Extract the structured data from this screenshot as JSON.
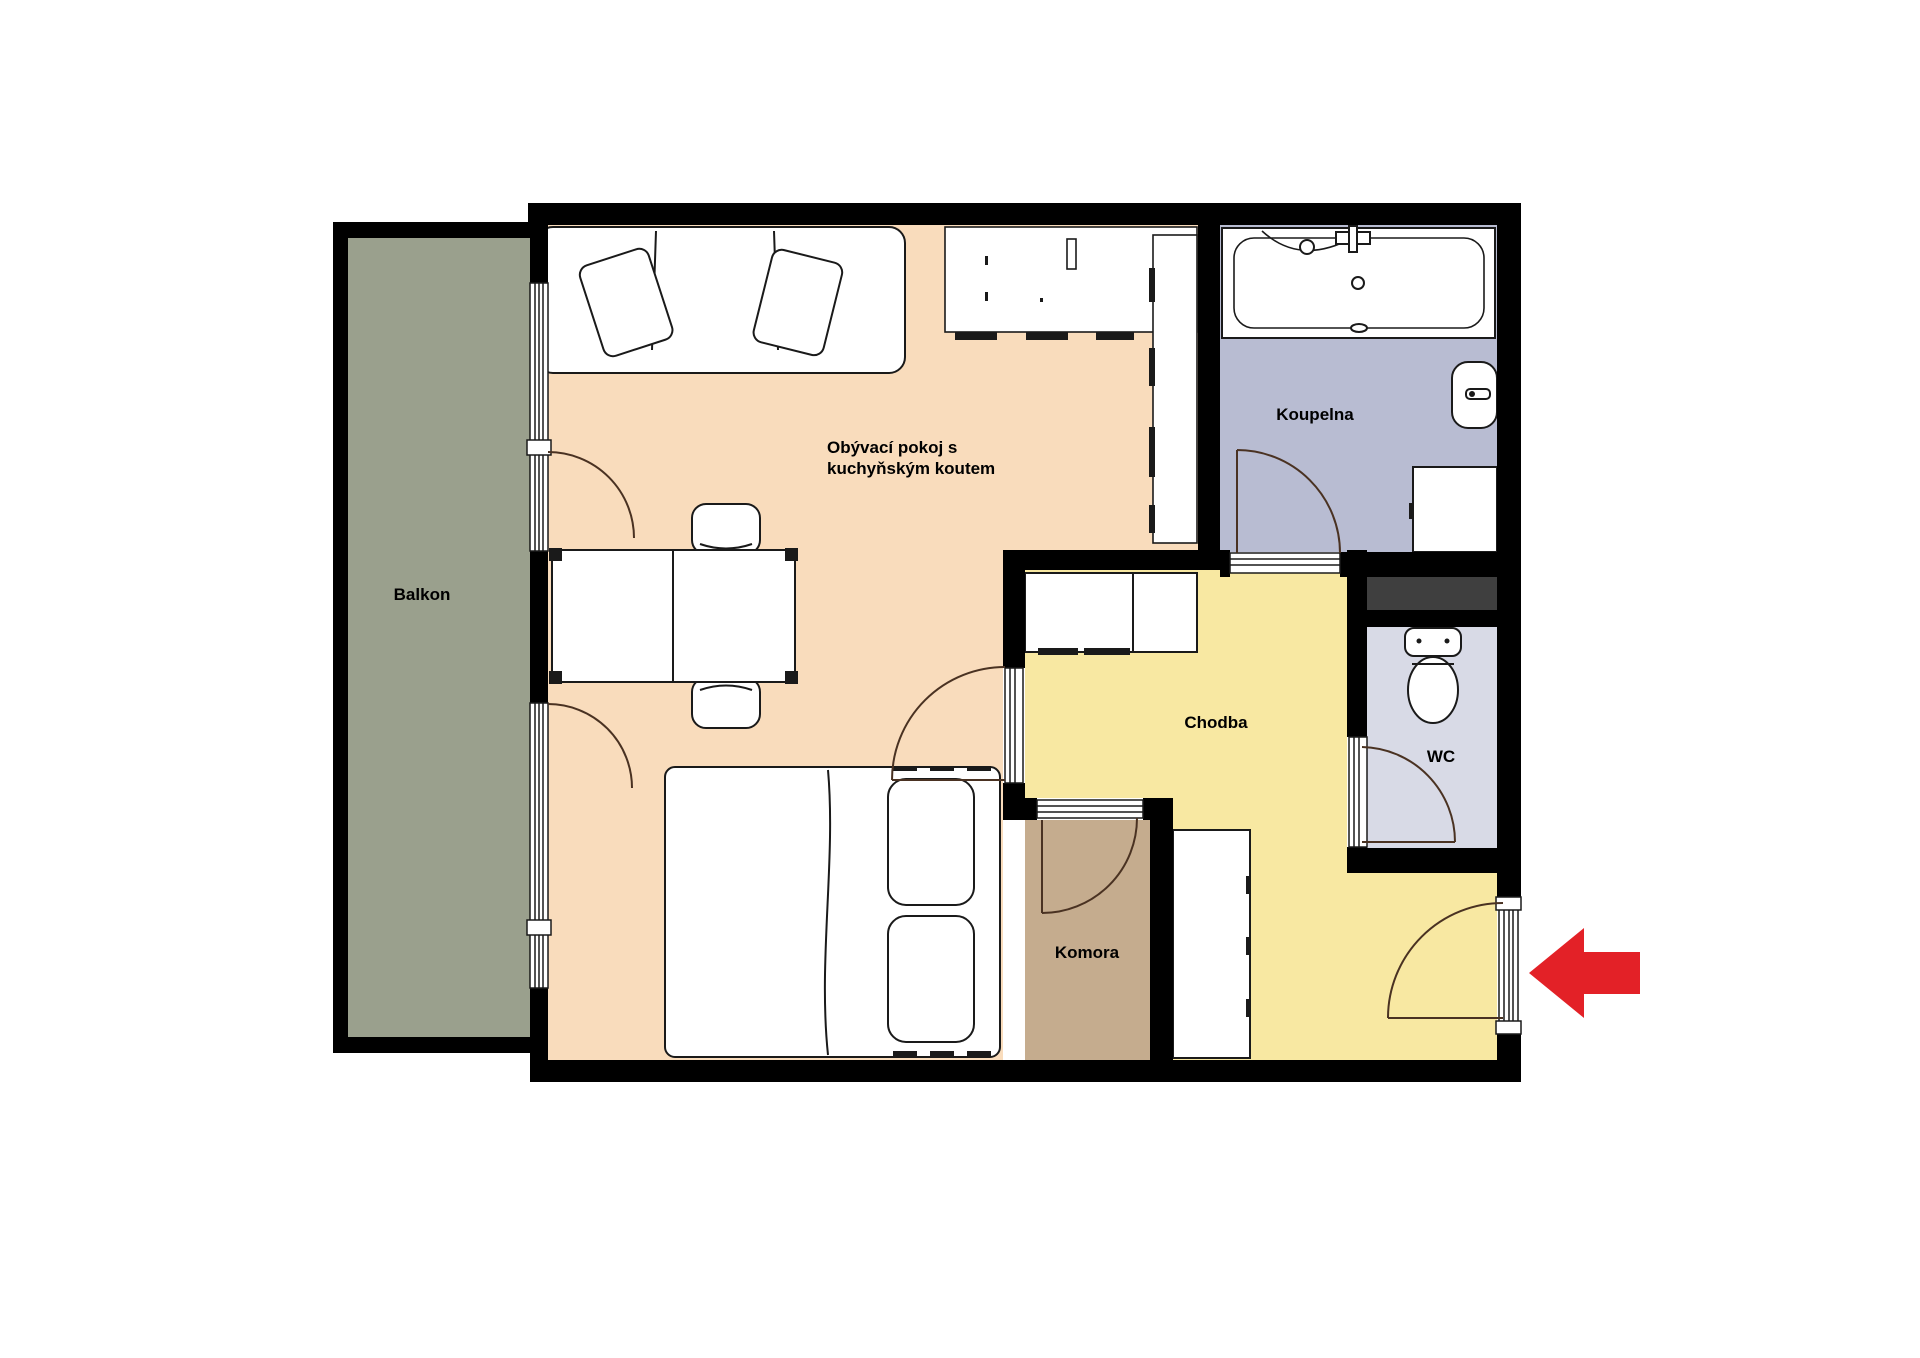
{
  "rooms": {
    "living": {
      "label_line1": "Obývací pokoj s",
      "label_line2": "kuchyňským koutem",
      "color": "#f9dcbc"
    },
    "balcony": {
      "label": "Balkon",
      "color": "#9aa08d"
    },
    "bathroom": {
      "label": "Koupelna",
      "color": "#b8bcd2"
    },
    "hallway": {
      "label": "Chodba",
      "color": "#f8e8a2"
    },
    "wc": {
      "label": "WC",
      "color": "#d8dae6"
    },
    "storage": {
      "label": "Komora",
      "color": "#c5ac8e"
    }
  },
  "entrance_arrow": {
    "color": "#e32127"
  },
  "palette": {
    "wall": "#000000",
    "shaft": "#3f3f3f",
    "background": "#ffffff",
    "furniture_stroke": "#1a1a1a",
    "door_arc": "#4a3222"
  }
}
